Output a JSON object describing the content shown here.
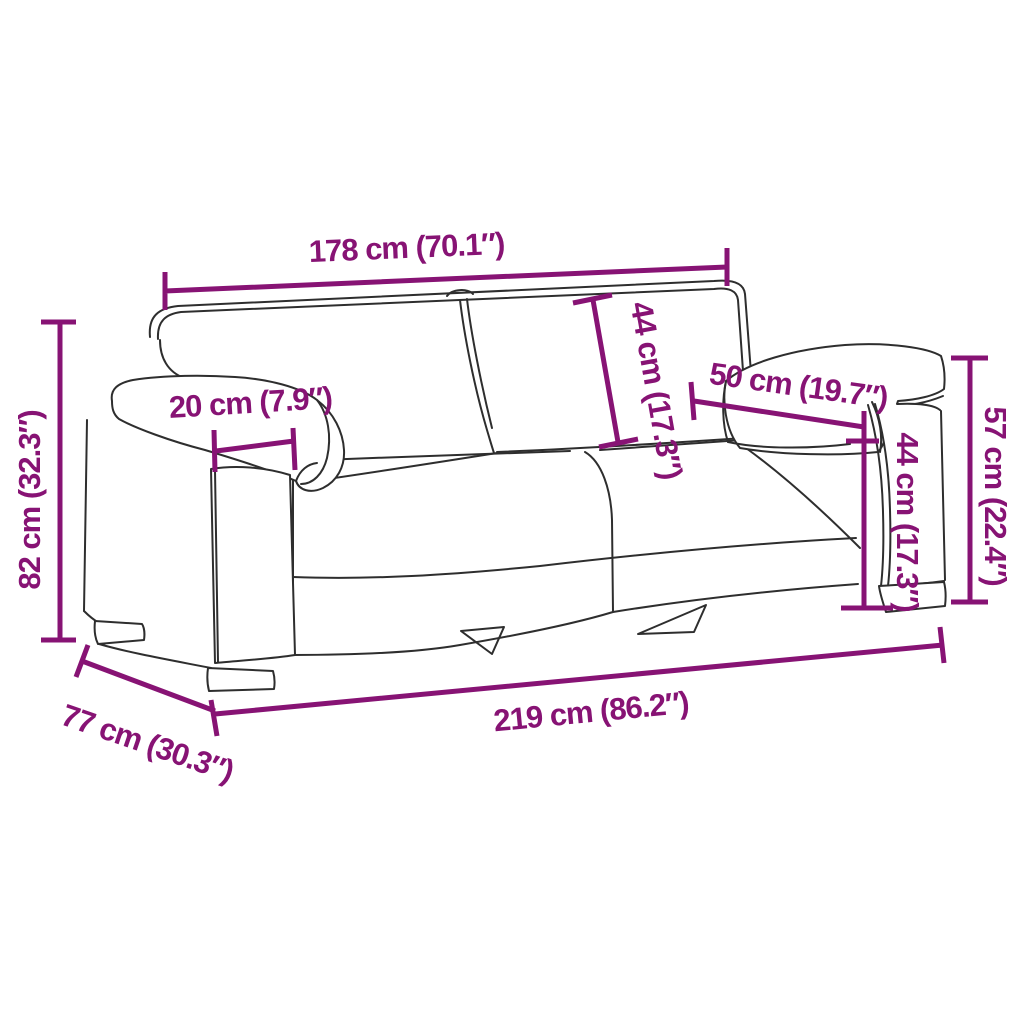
{
  "diagram": {
    "title": "sofa-dimension-diagram",
    "product": "two-seater sofa line sketch",
    "background": "#ffffff",
    "accent_color": "#871374",
    "sketch_color": "#2e2e2e",
    "dimensions": [
      {
        "id": "inner-width",
        "label": "178 cm (70.1″)"
      },
      {
        "id": "back-cushion-height",
        "label": "44 cm (17.3″)"
      },
      {
        "id": "armrest-depth",
        "label": "50 cm (19.7″)"
      },
      {
        "id": "armrest-width",
        "label": "20 cm (7.9″)"
      },
      {
        "id": "overall-height",
        "label": "82 cm (32.3″)"
      },
      {
        "id": "armrest-height",
        "label": "57 cm (22.4″)"
      },
      {
        "id": "seat-height",
        "label": "44 cm (17.3″)"
      },
      {
        "id": "depth",
        "label": "77 cm (30.3″)"
      },
      {
        "id": "overall-width",
        "label": "219 cm (86.2″)"
      }
    ]
  }
}
